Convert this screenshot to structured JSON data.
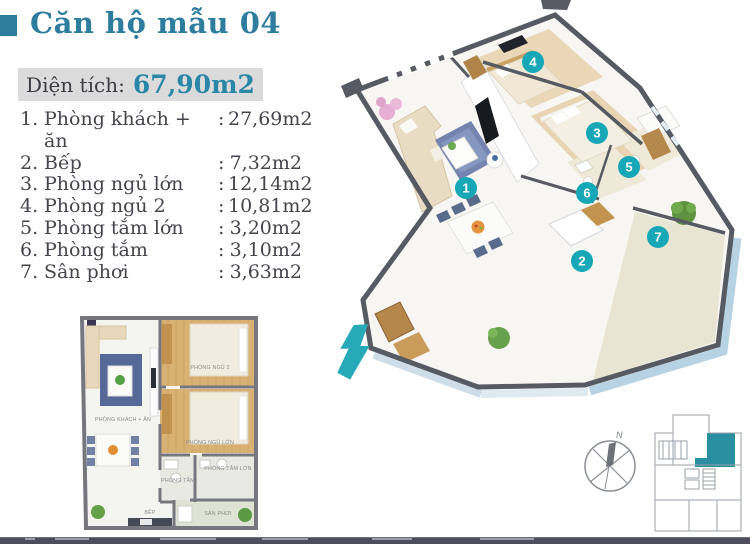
{
  "header": {
    "title": "Căn hộ mẫu 04"
  },
  "area_box": {
    "label": "Diện tích:",
    "value": "67,90m2"
  },
  "separator": ":",
  "rooms": [
    {
      "no": "1.",
      "name": "Phòng khách + ăn",
      "area": "27,69m2"
    },
    {
      "no": "2.",
      "name": "Bếp",
      "area": "7,32m2"
    },
    {
      "no": "3.",
      "name": "Phòng ngủ lớn",
      "area": "12,14m2"
    },
    {
      "no": "4.",
      "name": "Phòng ngủ 2",
      "area": "10,81m2"
    },
    {
      "no": "5.",
      "name": "Phòng tắm lớn",
      "area": "3,20m2"
    },
    {
      "no": "6.",
      "name": "Phòng tắm",
      "area": "3,10m2"
    },
    {
      "no": "7.",
      "name": "Sân phơi",
      "area": "3,63m2"
    }
  ],
  "plan3d": {
    "markers": [
      "1",
      "2",
      "3",
      "4",
      "5",
      "6",
      "7"
    ]
  },
  "plan2d": {
    "labels": {
      "living": "PHÒNG KHÁCH + ĂN",
      "bedroom2": "PHÒNG NGỦ 2",
      "master": "PHÒNG NGỦ LỚN",
      "bath_big": "PHÒNG TẮM LỚN",
      "bath": "PHÒNG TẮM",
      "kitchen": "BẾP",
      "balcony": "SÂN PHƠI"
    }
  },
  "compass": {
    "north": "N"
  },
  "colors": {
    "title_teal": "#2e7d9e",
    "value_teal": "#2a87a7",
    "marker_teal": "#17a7b7",
    "arrow_teal": "#27a9b8",
    "unit_highlight": "#2b8fa2",
    "wall_dark": "#565a62",
    "footer_bar": "#4d4d5f",
    "area_box_bg": "#dbdbdb"
  }
}
